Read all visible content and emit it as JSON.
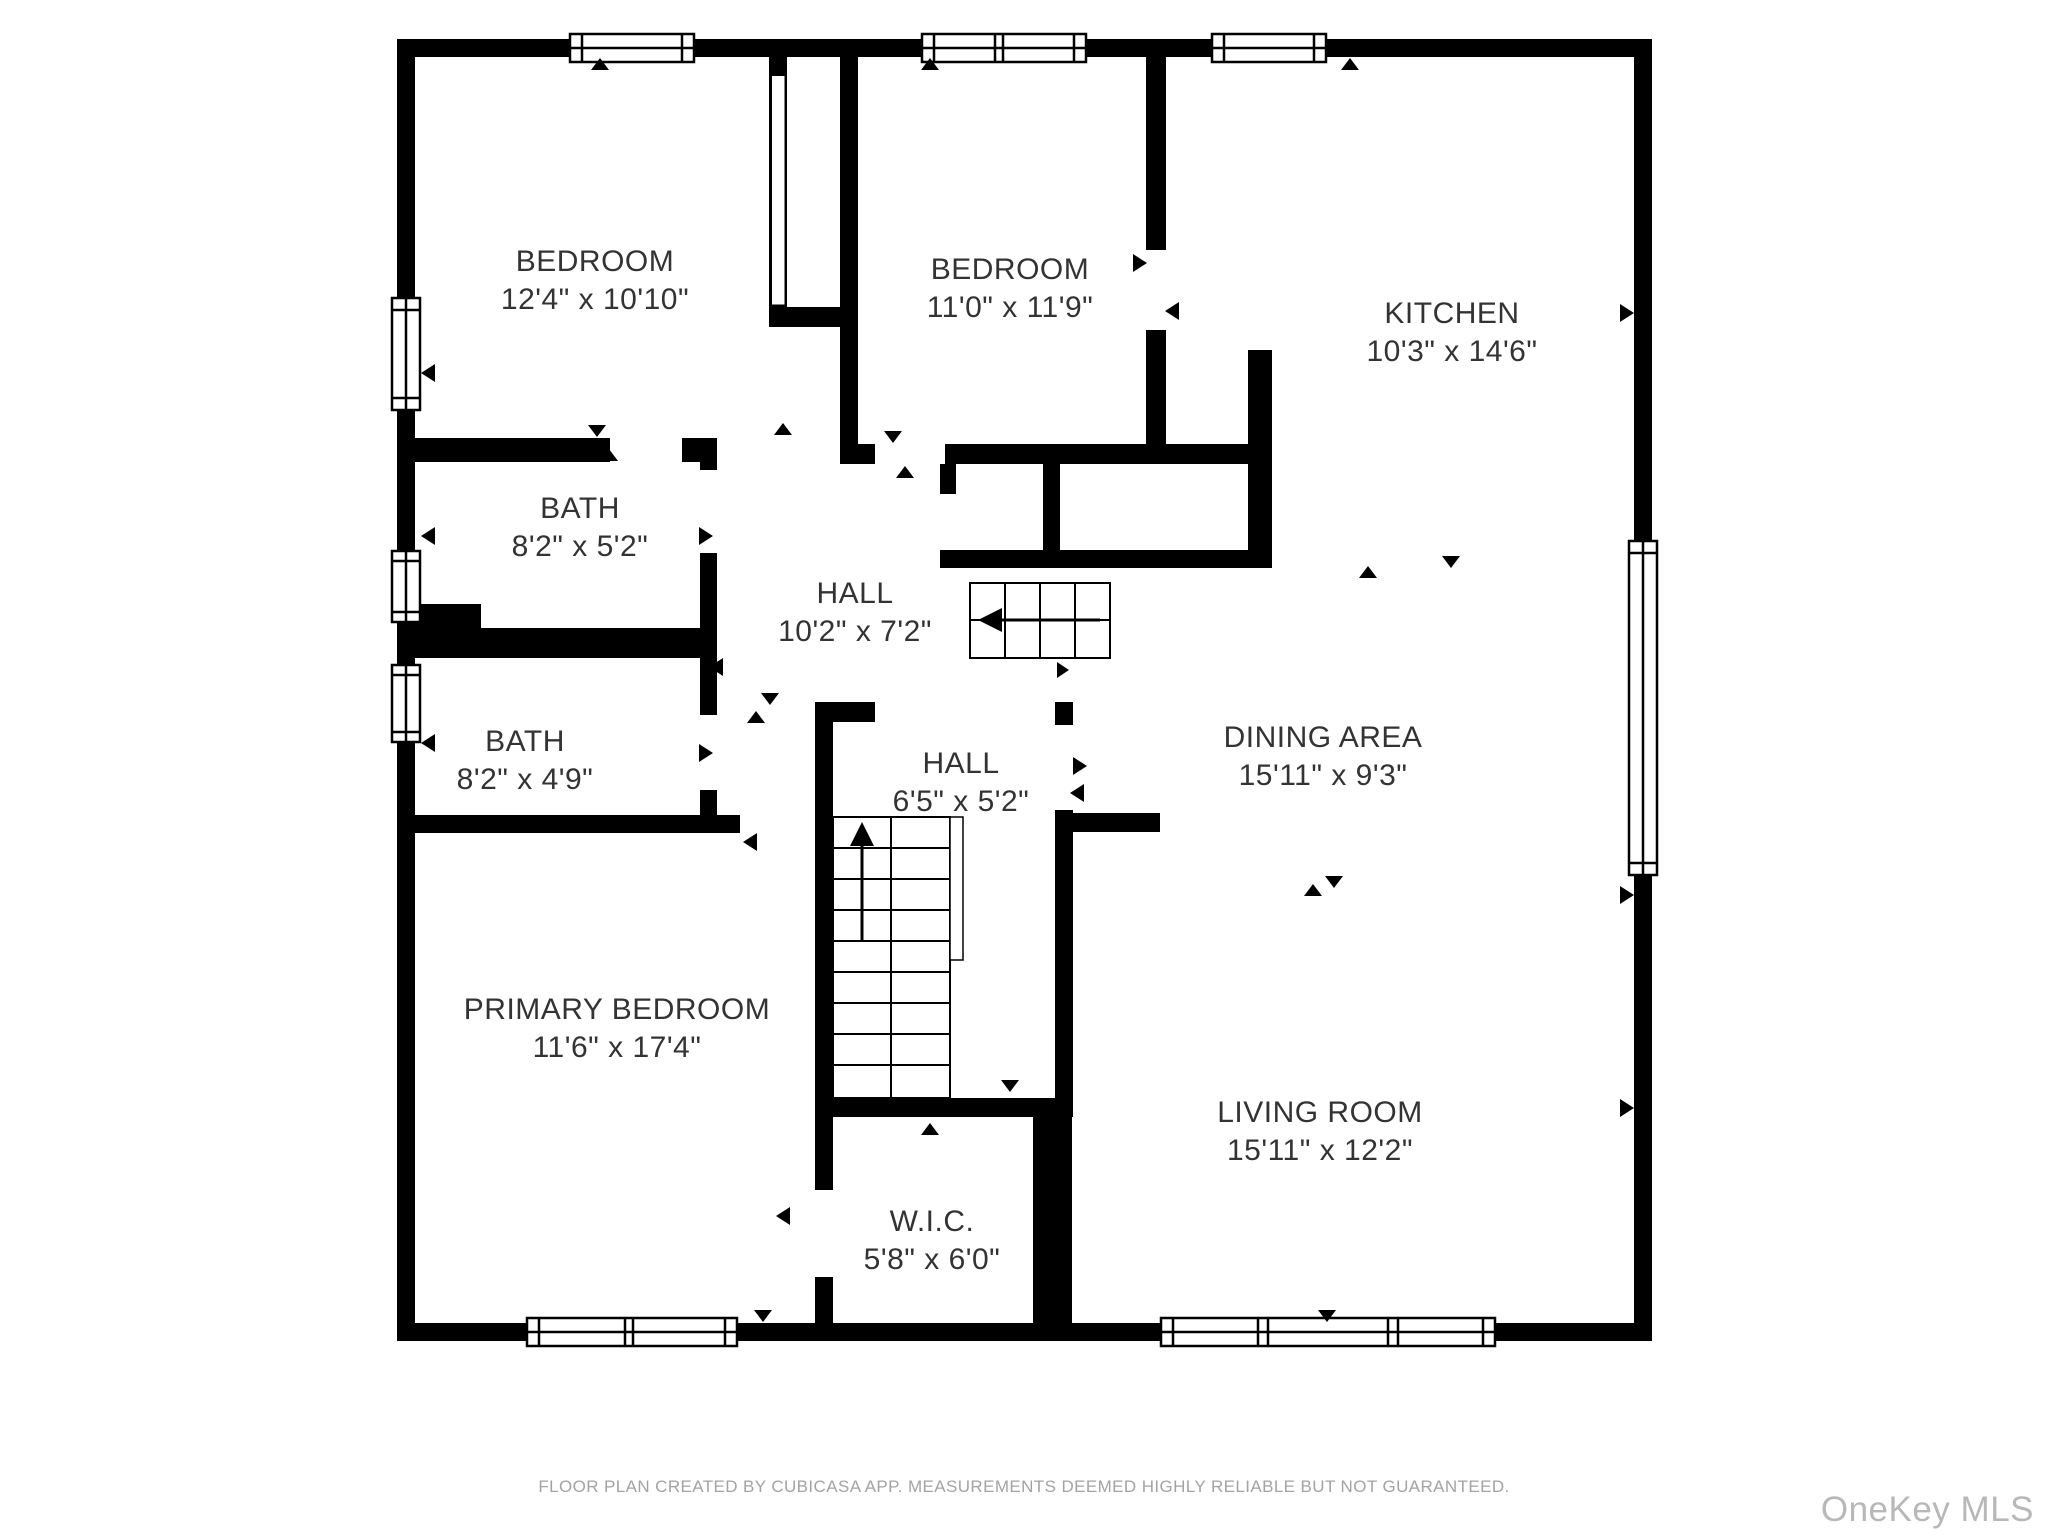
{
  "page": {
    "type": "floor-plan",
    "creator_app": "CubiCasa"
  },
  "rooms": [
    {
      "id": "bedroom-1",
      "name": "BEDROOM",
      "dims": "12'4\" x 10'10\""
    },
    {
      "id": "bedroom-2",
      "name": "BEDROOM",
      "dims": "11'0\" x 11'9\""
    },
    {
      "id": "kitchen",
      "name": "KITCHEN",
      "dims": "10'3\" x 14'6\""
    },
    {
      "id": "bath-1",
      "name": "BATH",
      "dims": "8'2\" x 5'2\""
    },
    {
      "id": "hall-1",
      "name": "HALL",
      "dims": "10'2\" x 7'2\""
    },
    {
      "id": "bath-2",
      "name": "BATH",
      "dims": "8'2\" x 4'9\""
    },
    {
      "id": "hall-2",
      "name": "HALL",
      "dims": "6'5\" x 5'2\""
    },
    {
      "id": "dining-area",
      "name": "DINING AREA",
      "dims": "15'11\" x 9'3\""
    },
    {
      "id": "primary-bedroom",
      "name": "PRIMARY BEDROOM",
      "dims": "11'6\" x 17'4\""
    },
    {
      "id": "living-room",
      "name": "LIVING ROOM",
      "dims": "15'11\" x 12'2\""
    },
    {
      "id": "wic",
      "name": "W.I.C.",
      "dims": "5'8\" x 6'0\""
    }
  ],
  "footer": {
    "disclaimer": "FLOOR PLAN CREATED BY CUBICASA APP. MEASUREMENTS DEEMED HIGHLY RELIABLE BUT NOT GUARANTEED."
  },
  "watermark": {
    "text": "OneKey MLS"
  },
  "colors": {
    "wall": "#000000",
    "floor": "#ffffff",
    "label_text": "#333333",
    "disclaimer_text": "#a3a3a3",
    "watermark_text": "#b8b8b8"
  }
}
